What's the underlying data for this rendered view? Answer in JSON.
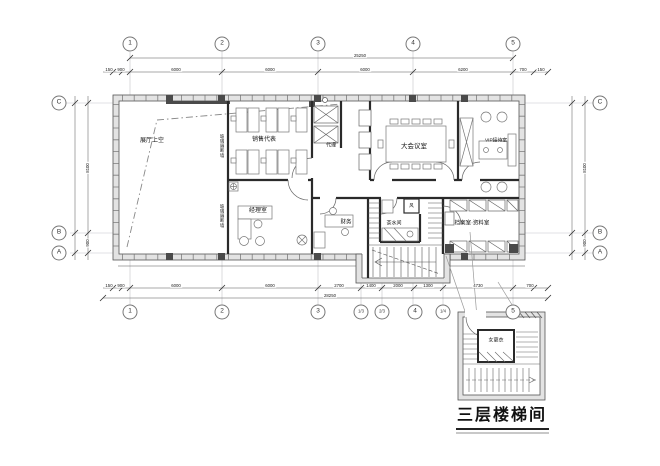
{
  "drawing": {
    "detail_title": "三层楼梯间",
    "rooms": {
      "void": "展厅上空",
      "sales": "销售代表",
      "agents": "代理",
      "conference": "大会议室",
      "vip": "VIP接待室",
      "manager": "经理室",
      "finance": "财务",
      "tea": "茶水间",
      "shaft": "风",
      "archive": "档案室·资料室",
      "changing": "女更衣"
    },
    "wall_label": "玻璃隔断墙",
    "grid": {
      "top": [
        "1",
        "2",
        "3",
        "4",
        "5"
      ],
      "bottom": [
        "1",
        "2",
        "3",
        "1/3",
        "2/3",
        "4",
        "1/4",
        "5"
      ],
      "left": [
        "C",
        "B",
        "A"
      ],
      "right": [
        "C",
        "B",
        "A"
      ]
    },
    "dims": {
      "top": [
        "150",
        "900",
        "6000",
        "6000",
        "6000",
        "6200",
        "700",
        "150"
      ],
      "top_total": "25250",
      "bottom": [
        "150",
        "900",
        "6000",
        "6000",
        "2700",
        "1400",
        "2000",
        "1300",
        "4730",
        "700"
      ],
      "bottom_total": "28250",
      "left": [
        "8100",
        "900"
      ],
      "right": [
        "8100",
        "900"
      ]
    },
    "colors": {
      "wall_fill": "#e3e3e3",
      "line": "#2a2a2a"
    }
  }
}
